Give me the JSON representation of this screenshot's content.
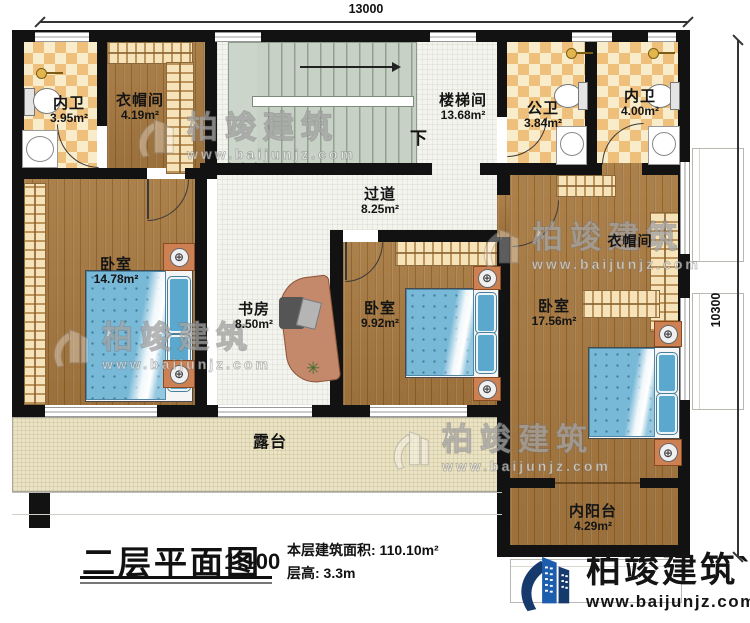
{
  "dimensions": {
    "width_label": "13000",
    "height_label": "10300"
  },
  "rooms": {
    "bath_master_left": {
      "name": "内卫",
      "area": "3.95m²"
    },
    "cloak_left": {
      "name": "衣帽间",
      "area": "4.19m²"
    },
    "stairwell": {
      "name": "楼梯间",
      "area": "13.68m²",
      "down": "下"
    },
    "bath_public": {
      "name": "公卫",
      "area": "3.84m²"
    },
    "bath_master_right": {
      "name": "内卫",
      "area": "4.00m²"
    },
    "corridor": {
      "name": "过道",
      "area": "8.25m²"
    },
    "bedroom_left": {
      "name": "卧室",
      "area": "14.78m²"
    },
    "study": {
      "name": "书房",
      "area": "8.50m²"
    },
    "bedroom_mid": {
      "name": "卧室",
      "area": "9.92m²"
    },
    "bedroom_right": {
      "name": "卧室",
      "area": "17.56m²"
    },
    "cloak_right": {
      "name": "衣帽间"
    },
    "terrace": {
      "name": "露台"
    },
    "balcony": {
      "name": "内阳台",
      "area": "4.29m²"
    }
  },
  "title_block": {
    "title": "二层平面图",
    "scale": "1:100",
    "area_line": "本层建筑面积: 110.10m²",
    "floor_height_line": "层高: 3.3m"
  },
  "brand": {
    "name": "柏竣建筑",
    "accent": "`",
    "website": "www.baijunjz.com"
  },
  "colors": {
    "logo_blue": "#1d5dae",
    "logo_navy": "#173a6d",
    "wall": "#121212",
    "wood": "#a8793f",
    "tile_accent": "#eec07c",
    "stair": "#c7d1c5",
    "terrace": "#ebe3c6",
    "bed": "#79b9d8"
  }
}
